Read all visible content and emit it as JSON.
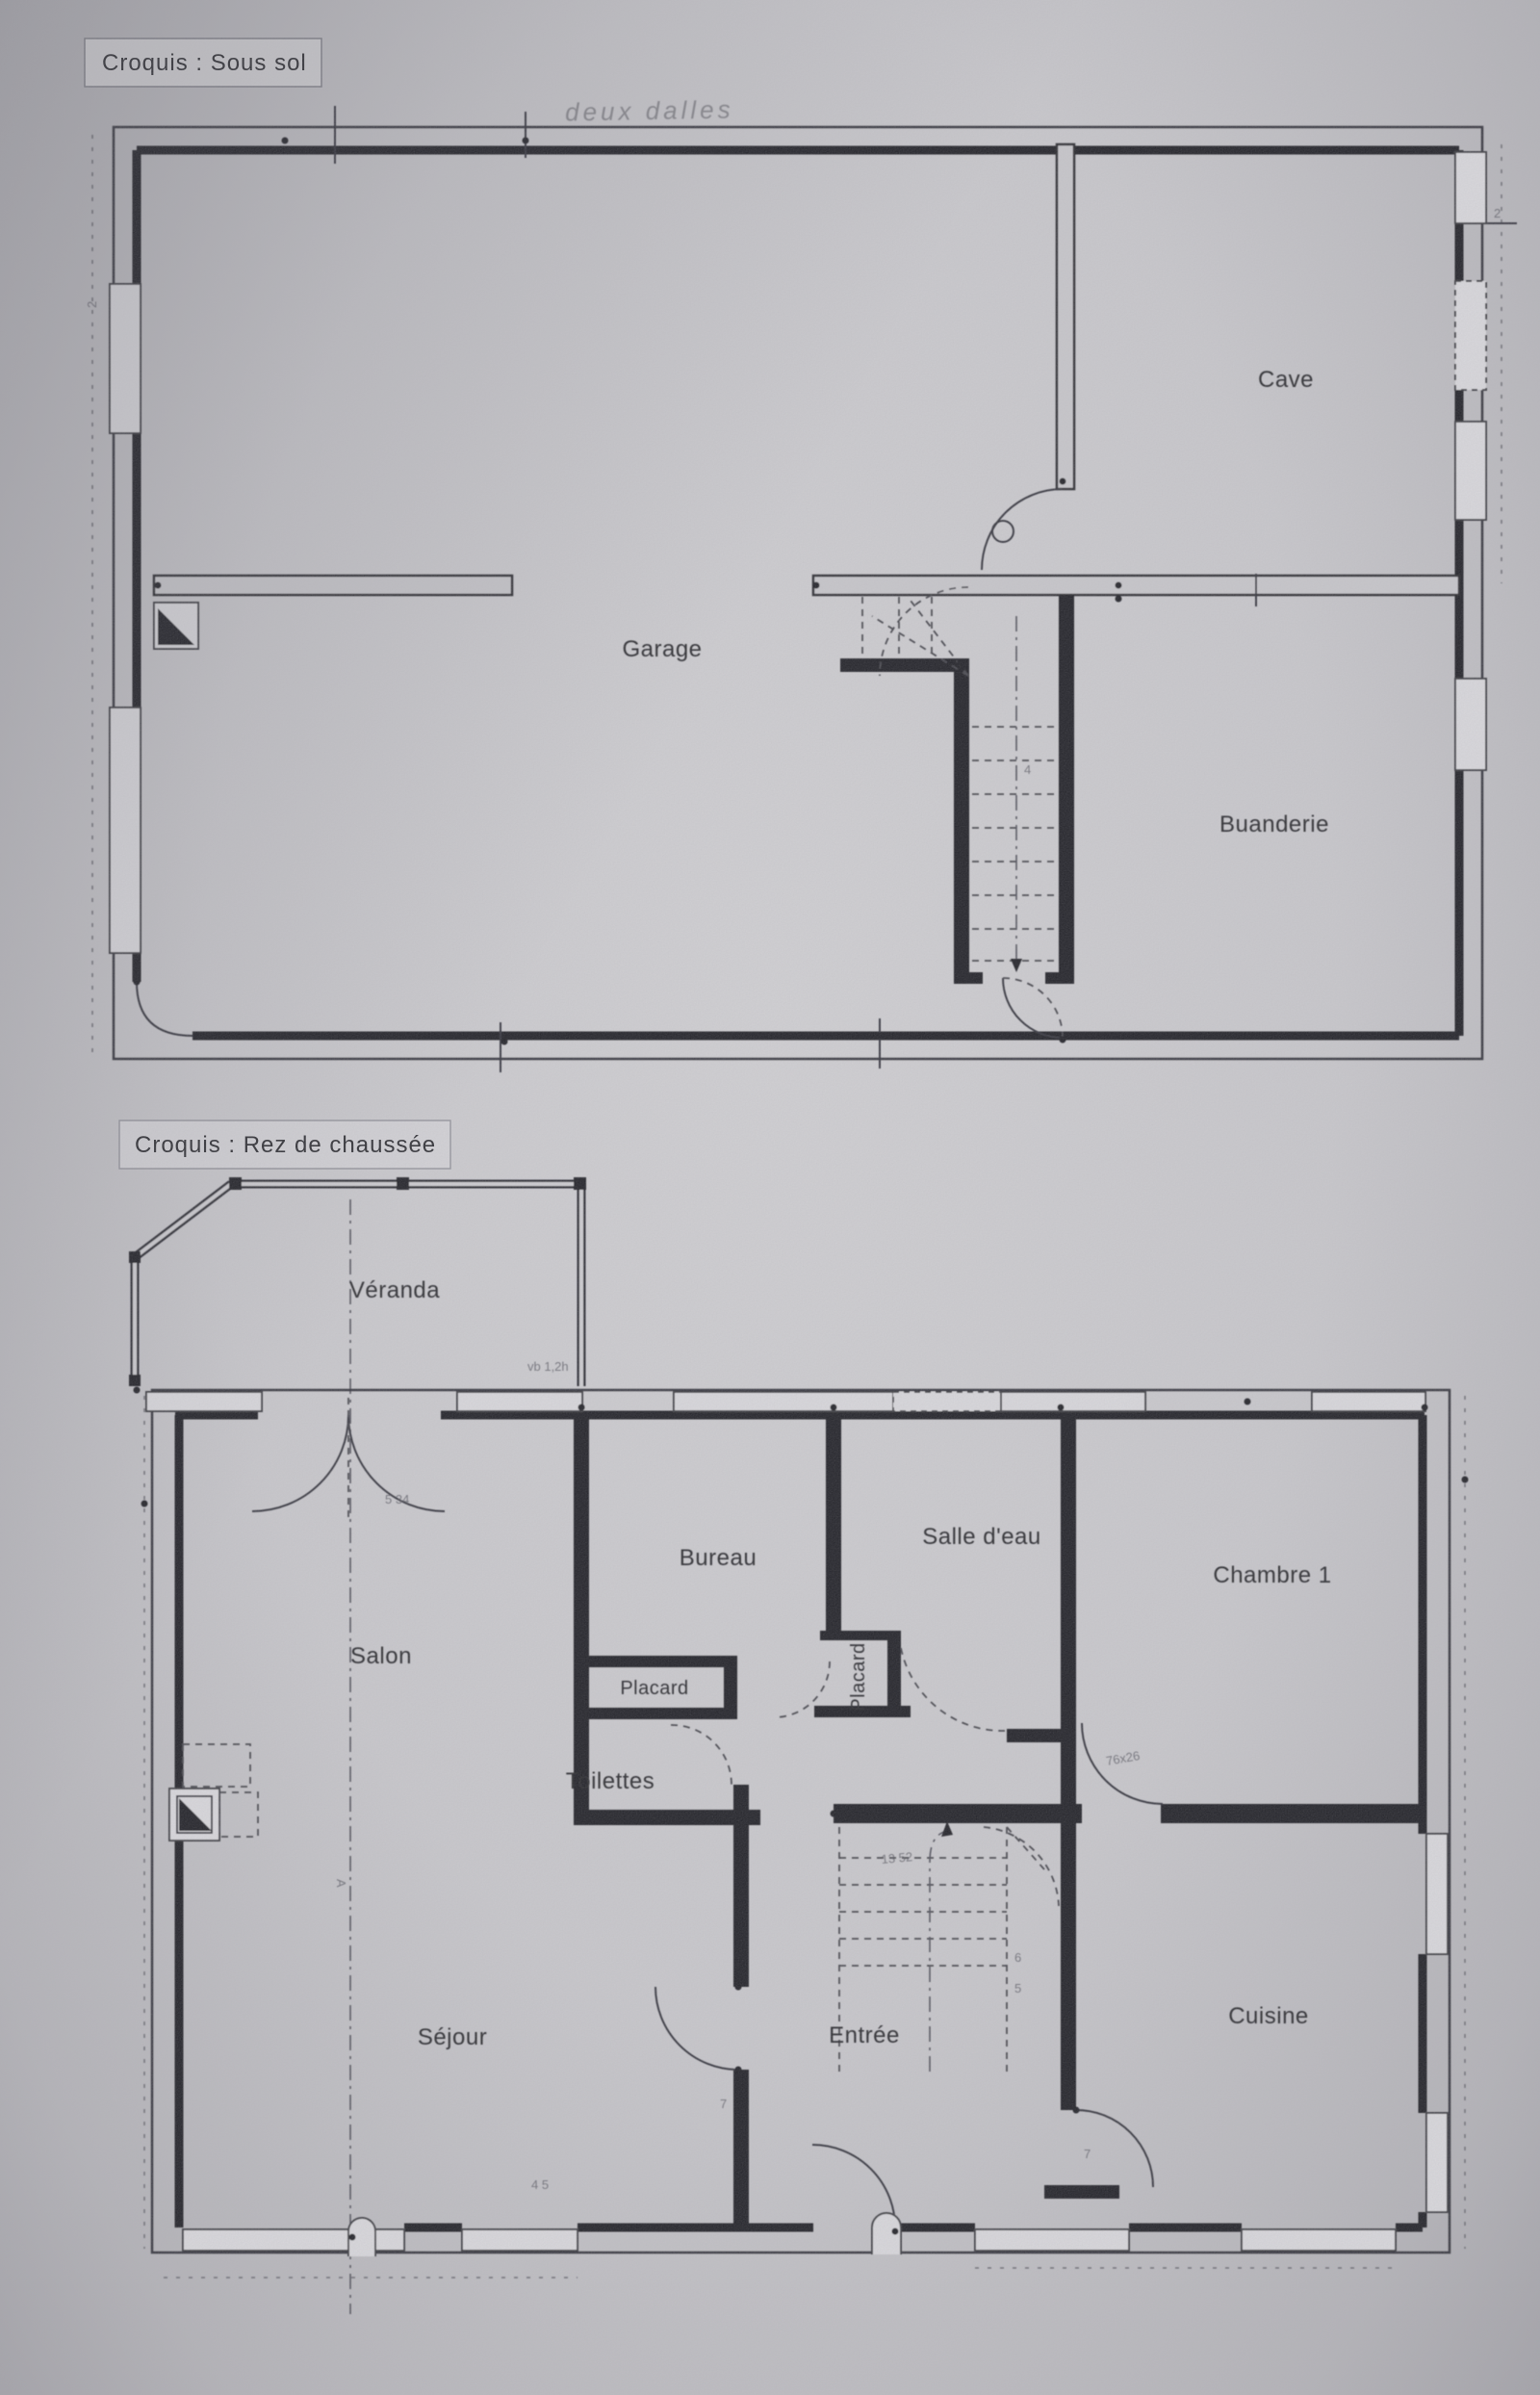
{
  "photo": {
    "paper_color": "#cac9cd",
    "ink_color": "#222226"
  },
  "titles": {
    "basement": "Croquis : Sous sol",
    "ground_floor": "Croquis : Rez de chaussée"
  },
  "basement": {
    "rooms": {
      "garage": "Garage",
      "cave": "Cave",
      "buanderie": "Buanderie"
    },
    "annotations": {
      "hand_note": "deux dalles",
      "dim_right": "2",
      "dim_left": "2",
      "stair_note": "4"
    }
  },
  "ground_floor": {
    "rooms": {
      "veranda": "Véranda",
      "salon": "Salon",
      "bureau": "Bureau",
      "salle_eau": "Salle d'eau",
      "chambre_1": "Chambre 1",
      "placard_salon": "Placard",
      "placard_couloir": "Placard",
      "toilettes": "Toilettes",
      "sejour": "Séjour",
      "entree": "Entrée",
      "cuisine": "Cuisine"
    },
    "annotations": {
      "section_marker": "A",
      "dim_doors": "5 34",
      "dim_window": "vb 1,2h",
      "dim_stairs": "13 52",
      "dim_chambre_door": "76x26",
      "dim_sejour_door": "7",
      "dim_cuisine_door": "7",
      "dim_sejour": "4 5",
      "stair_step_6": "6",
      "stair_step_5": "5"
    }
  }
}
